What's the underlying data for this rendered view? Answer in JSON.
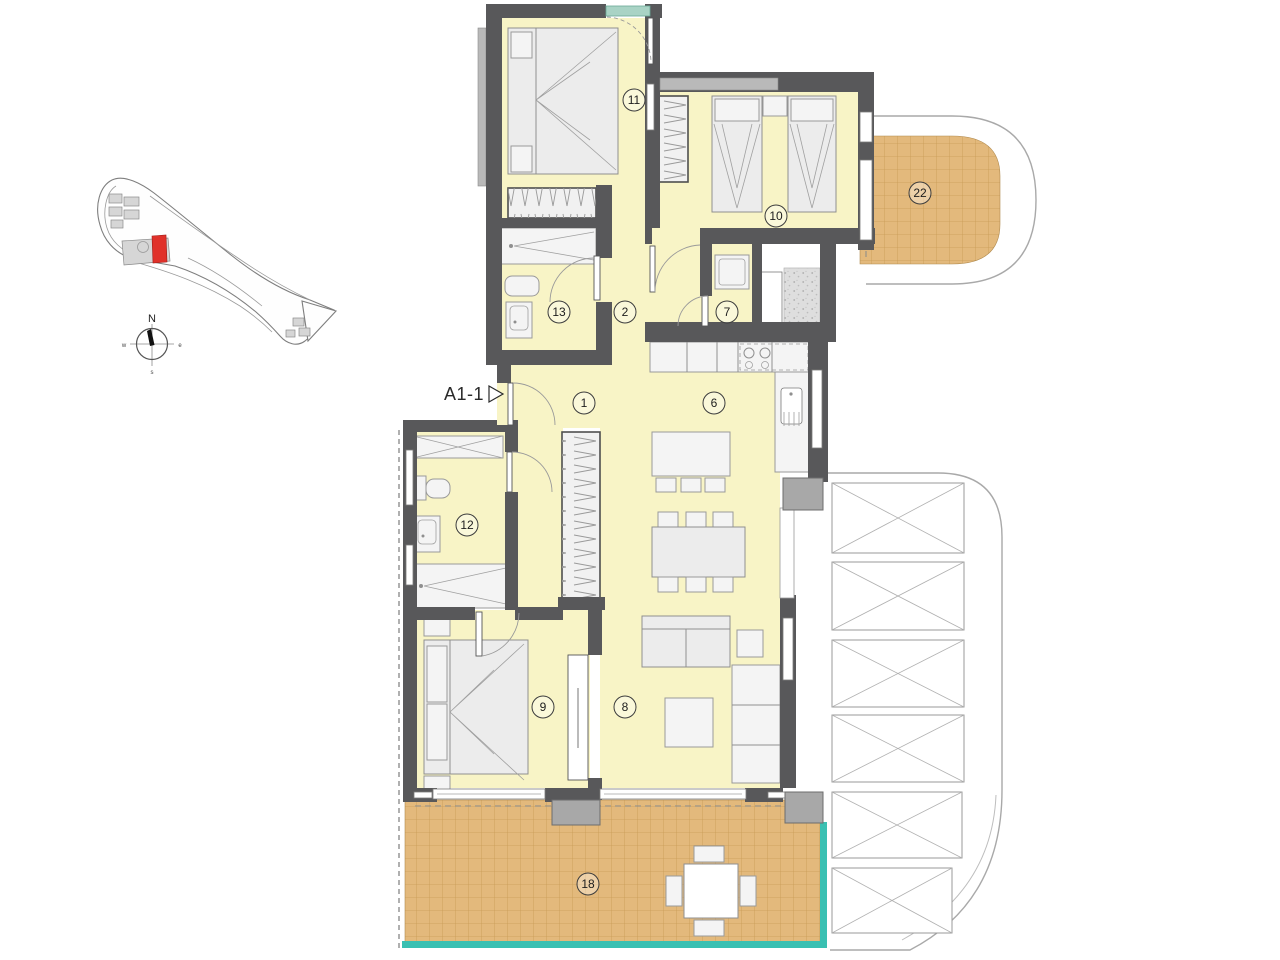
{
  "floor_plan": {
    "unit_label": "A1-1",
    "room_labels": {
      "r1": "1",
      "r2": "2",
      "r6": "6",
      "r7": "7",
      "r8": "8",
      "r9": "9",
      "r10": "10",
      "r11": "11",
      "r12": "12",
      "r13": "13",
      "r18": "18",
      "r22": "22"
    },
    "compass": {
      "north": "N",
      "east": "e",
      "south": "s",
      "west": "w"
    },
    "colors": {
      "wall": "#58585a",
      "floor": "#f8f4c6",
      "terrace": "#e3b97c",
      "terrace_grid": "#c99b55",
      "balustrade": "#3ac0b2",
      "highlight_red": "#e0312a",
      "lintel_gray": "#b9b9b9",
      "door_lintel_green": "#a9d3c5"
    }
  }
}
